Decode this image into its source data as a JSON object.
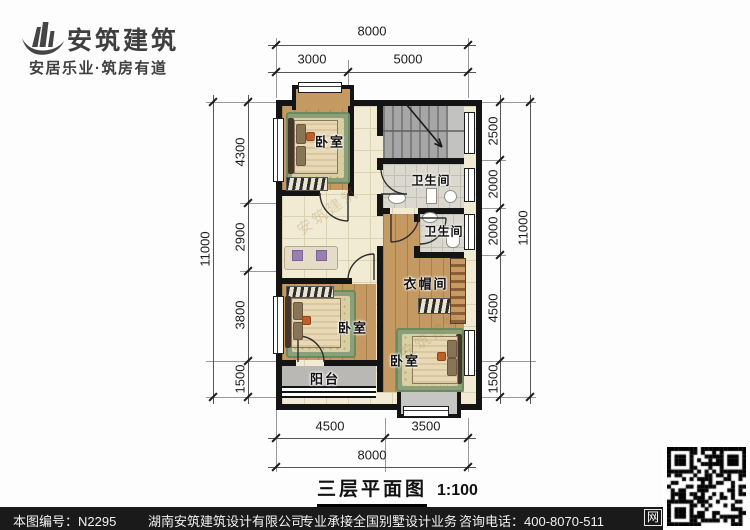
{
  "logo": {
    "company": "安筑建筑",
    "tagline": "安居乐业·筑房有道"
  },
  "plan": {
    "rooms": {
      "bedroom_top": "卧室",
      "bedroom_left": "卧室",
      "bedroom_right": "卧室",
      "bathroom_upper": "卫生间",
      "bathroom_lower": "卫生间",
      "cloakroom": "衣帽间",
      "balcony": "阳台"
    },
    "watermark": "安筑建筑"
  },
  "dims": {
    "top": {
      "total": "8000",
      "segments": [
        "3000",
        "5000"
      ]
    },
    "bottom": {
      "total": "8000",
      "segments": [
        "4500",
        "3500"
      ]
    },
    "left": {
      "total": "11000",
      "segments": [
        "4300",
        "2900",
        "3800",
        "1500"
      ]
    },
    "right": {
      "total": "11000",
      "segments": [
        "2500",
        "2000",
        "2000",
        "4500",
        "1500"
      ]
    }
  },
  "title": {
    "text": "三层平面图",
    "scale": "1:100"
  },
  "footer": {
    "drawing_no": "本图编号：N2295",
    "company": "湖南安筑建筑设计有限公司",
    "service": "专业承接全国别墅设计业务",
    "phone": "咨询电话：400-8070-511",
    "web_badge": "网"
  },
  "colors": {
    "wall": "#141414",
    "wood_floor": "#c49a62",
    "tile_floor": "#f2ebd3",
    "bath_tile": "#dbd9cf",
    "stair": "#a6a6a6",
    "balcony": "#b9b8b4",
    "rug_green": "#8ba07a",
    "footer_bg": "#1a1a1a"
  }
}
